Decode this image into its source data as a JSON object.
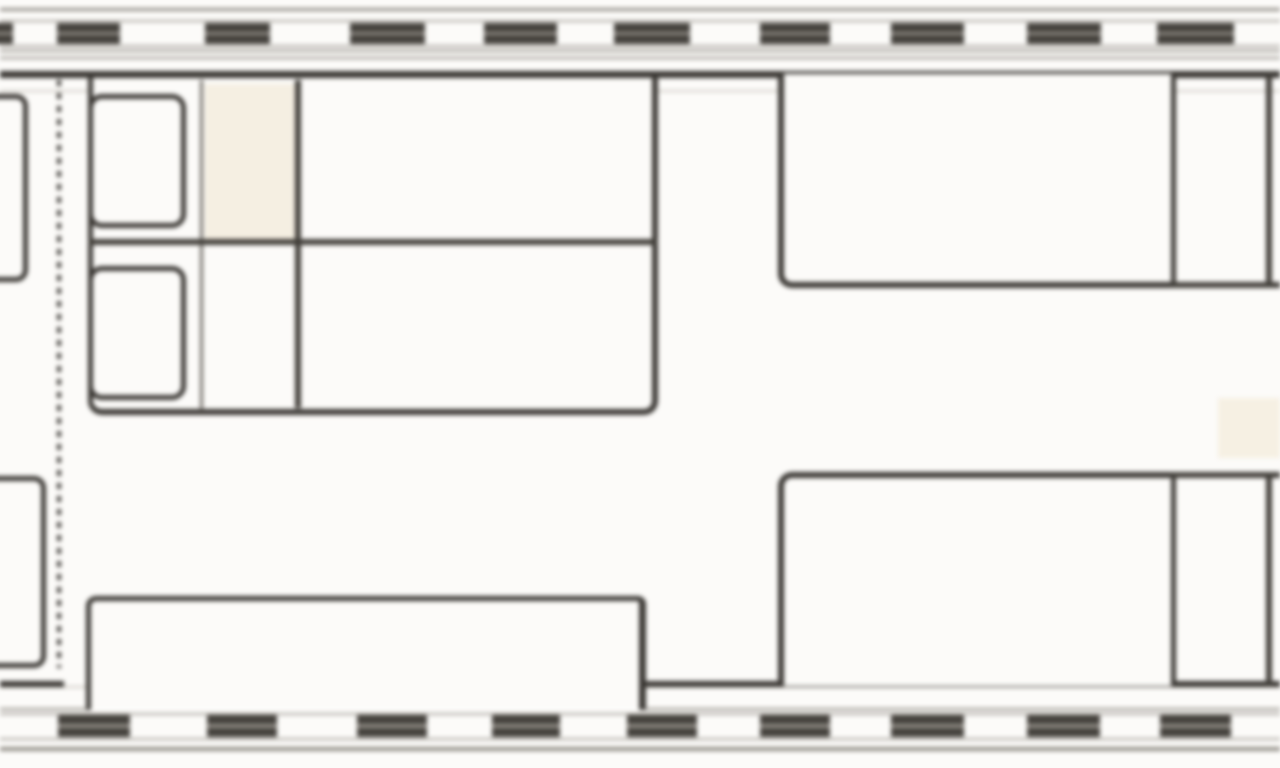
{
  "meta": {
    "description": "Blurred monochrome floor plan of a sleeper/caravan interior: window walls at top and bottom, twin bed with two pillows at left, two large beds at right, bottom bench, partial berths cut off at the left edge, dashed partition line",
    "canvas_width": 1280,
    "canvas_height": 768
  },
  "colors": {
    "paper": "#fcfbf9",
    "line_dark": "#3a3733",
    "line_medium": "#6e6a64",
    "window_dark": "#45423d",
    "window_stripe": "#908c85"
  },
  "lines": [
    {
      "name": "top-outer-edge-line",
      "x": 0,
      "y": 8,
      "w": 1280,
      "h": 3,
      "color": "#918d86"
    },
    {
      "name": "top-window-band-upper-line",
      "x": 0,
      "y": 20,
      "w": 1280,
      "h": 2,
      "color": "#a8a49d"
    },
    {
      "name": "top-window-band-lower-line",
      "x": 0,
      "y": 45,
      "w": 1280,
      "h": 2,
      "color": "#a8a49d"
    },
    {
      "name": "top-sill-line-outer",
      "x": 0,
      "y": 50,
      "w": 1280,
      "h": 2,
      "color": "#918d86"
    },
    {
      "name": "top-sill-line-inner",
      "x": 0,
      "y": 57,
      "w": 1280,
      "h": 2,
      "color": "#918d86"
    },
    {
      "name": "top-inner-wall-line",
      "x": 0,
      "y": 71,
      "w": 1280,
      "h": 7,
      "color": "#3a3733"
    },
    {
      "name": "top-wall-face-line",
      "x": 0,
      "y": 90,
      "w": 1280,
      "h": 2,
      "color": "#d2cec7"
    },
    {
      "name": "bottom-wall-face-line",
      "x": 0,
      "y": 686,
      "w": 1280,
      "h": 2,
      "color": "#cdc9c2"
    },
    {
      "name": "bottom-inner-wall-line-left",
      "x": 0,
      "y": 681,
      "w": 64,
      "h": 6,
      "color": "#3a3733"
    },
    {
      "name": "bottom-inner-wall-line-right",
      "x": 643,
      "y": 681,
      "w": 637,
      "h": 6,
      "color": "#3a3733"
    },
    {
      "name": "bottom-wall-mid-line",
      "x": 0,
      "y": 708,
      "w": 1280,
      "h": 2,
      "color": "#918d86"
    },
    {
      "name": "bottom-window-band-upper-line",
      "x": 0,
      "y": 713,
      "w": 1280,
      "h": 2,
      "color": "#a8a49d"
    },
    {
      "name": "bottom-window-band-lower-line",
      "x": 0,
      "y": 738,
      "w": 1280,
      "h": 2,
      "color": "#a8a49d"
    },
    {
      "name": "bottom-outer-edge-line",
      "x": 0,
      "y": 747,
      "w": 1280,
      "h": 4,
      "color": "#918d86"
    }
  ],
  "walls": {
    "top": {
      "block_y": 23,
      "block_h": 21,
      "window_blocks": [
        [
          -60,
          13
        ],
        [
          57,
          120
        ],
        [
          205,
          270
        ],
        [
          350,
          425
        ],
        [
          484,
          557
        ],
        [
          614,
          690
        ],
        [
          760,
          830
        ],
        [
          891,
          964
        ],
        [
          1027,
          1101
        ],
        [
          1157,
          1234
        ]
      ]
    },
    "bottom": {
      "block_y": 715,
      "block_h": 22,
      "window_blocks": [
        [
          58,
          130
        ],
        [
          207,
          277
        ],
        [
          357,
          427
        ],
        [
          492,
          560
        ],
        [
          627,
          697
        ],
        [
          760,
          830
        ],
        [
          891,
          964
        ],
        [
          1027,
          1100
        ],
        [
          1160,
          1231
        ]
      ]
    }
  },
  "furniture": [
    {
      "name": "left-upper-berth",
      "x": -36,
      "y": 94,
      "w": 64,
      "h": 188,
      "bw": [
        5,
        5,
        5,
        5
      ],
      "r": [
        10,
        12,
        12,
        10
      ]
    },
    {
      "name": "left-lower-berth",
      "x": -36,
      "y": 476,
      "w": 82,
      "h": 192,
      "bw": [
        5,
        5,
        5,
        5
      ],
      "r": [
        10,
        12,
        12,
        10
      ]
    },
    {
      "name": "partition-dashed-line",
      "type": "vdash",
      "x": 57,
      "y": 80,
      "w": 4,
      "h": 588,
      "dash": 6,
      "gap": 7
    },
    {
      "name": "twin-bed-platform",
      "x": 88,
      "y": 78,
      "w": 570,
      "h": 337,
      "bw": [
        0,
        6,
        6,
        5
      ],
      "r": [
        0,
        0,
        14,
        14
      ]
    },
    {
      "name": "bed-head-shading",
      "x": 205,
      "y": 84,
      "w": 92,
      "h": 156,
      "fill": "#f5efe2"
    },
    {
      "name": "bed-mattress-seam-left",
      "x": 200,
      "y": 80,
      "w": 3,
      "h": 330,
      "fill": "#6e6a64"
    },
    {
      "name": "bed-mattress-seam-right",
      "x": 295,
      "y": 80,
      "w": 6,
      "h": 328,
      "fill": "#413e39"
    },
    {
      "name": "bed-center-divider",
      "x": 88,
      "y": 239,
      "w": 570,
      "h": 6,
      "fill": "#413e39"
    },
    {
      "name": "pillow-upper",
      "x": 88,
      "y": 94,
      "w": 98,
      "h": 134,
      "bw": [
        5,
        5,
        5,
        5
      ],
      "r": [
        14,
        14,
        14,
        14
      ]
    },
    {
      "name": "pillow-lower",
      "x": 88,
      "y": 266,
      "w": 98,
      "h": 134,
      "bw": [
        5,
        5,
        5,
        5
      ],
      "r": [
        14,
        14,
        14,
        14
      ]
    },
    {
      "name": "right-upper-bed",
      "x": 778,
      "y": 74,
      "w": 398,
      "h": 214,
      "bw": [
        0,
        5,
        6,
        6
      ],
      "r": [
        0,
        0,
        0,
        14
      ]
    },
    {
      "name": "right-lower-bed",
      "x": 778,
      "y": 472,
      "w": 398,
      "h": 214,
      "bw": [
        6,
        5,
        0,
        6
      ],
      "r": [
        14,
        0,
        0,
        0
      ]
    },
    {
      "name": "right-end-upper-shelf-line",
      "x": 1171,
      "y": 282,
      "w": 109,
      "h": 6,
      "fill": "#413e39"
    },
    {
      "name": "right-end-lower-shelf-line",
      "x": 1171,
      "y": 472,
      "w": 109,
      "h": 6,
      "fill": "#413e39"
    },
    {
      "name": "right-end-upper-vertical",
      "x": 1266,
      "y": 74,
      "w": 6,
      "h": 214,
      "fill": "#413e39"
    },
    {
      "name": "right-end-lower-vertical",
      "x": 1266,
      "y": 472,
      "w": 6,
      "h": 214,
      "fill": "#413e39"
    },
    {
      "name": "aisle-floor-shading",
      "x": 1218,
      "y": 398,
      "w": 62,
      "h": 60,
      "fill": "#f6f0e3"
    },
    {
      "name": "bottom-bench",
      "x": 86,
      "y": 596,
      "w": 560,
      "h": 114,
      "bw": [
        5,
        7,
        0,
        5
      ],
      "r": [
        10,
        8,
        0,
        0
      ]
    }
  ]
}
